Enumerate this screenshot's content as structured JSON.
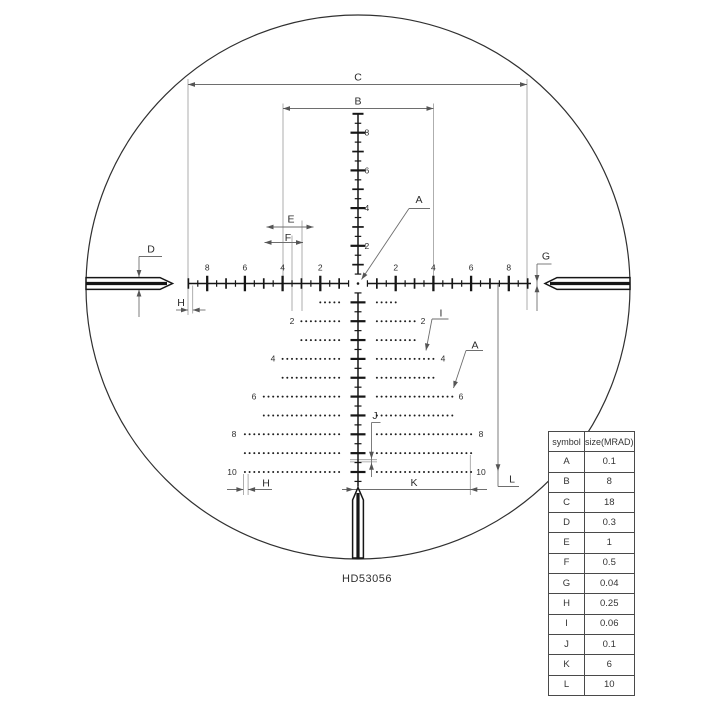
{
  "hd_label": "HD53056",
  "table": {
    "headers": [
      "symbol",
      "size(MRAD)"
    ],
    "rows": [
      [
        "A",
        "0.1"
      ],
      [
        "B",
        "8"
      ],
      [
        "C",
        "18"
      ],
      [
        "D",
        "0.3"
      ],
      [
        "E",
        "1"
      ],
      [
        "F",
        "0.5"
      ],
      [
        "G",
        "0.04"
      ],
      [
        "H",
        "0.25"
      ],
      [
        "I",
        "0.06"
      ],
      [
        "J",
        "0.1"
      ],
      [
        "K",
        "6"
      ],
      [
        "L",
        "10"
      ]
    ]
  },
  "chart_data": {
    "type": "diagram-reticle",
    "title": "HD53056 reticle subtension diagram",
    "units": "MRAD",
    "subtensions": {
      "A": 0.1,
      "B": 8,
      "C": 18,
      "D": 0.3,
      "E": 1,
      "F": 0.5,
      "G": 0.04,
      "H": 0.25,
      "I": 0.06,
      "J": 0.1,
      "K": 6,
      "L": 10
    }
  },
  "reticle": {
    "geom": {
      "cx": 358,
      "cy": 283.5,
      "scale": 18.85,
      "circle": [
        358,
        287,
        272
      ],
      "h_segments": [
        [
          188,
          348.5
        ],
        [
          367.5,
          531
        ]
      ],
      "v_segments_y": [
        [
          113.8,
          273.5
        ],
        [
          292.5,
          486.5
        ]
      ],
      "h_tick_range": [
        -9,
        9
      ],
      "v_up_max": 8.5,
      "v_down_max": 10.5
    },
    "h_axis_labels": [
      {
        "text": "8",
        "mrad": -8
      },
      {
        "text": "6",
        "mrad": -6
      },
      {
        "text": "4",
        "mrad": -4
      },
      {
        "text": "2",
        "mrad": -2
      },
      {
        "text": "2",
        "mrad": 2
      },
      {
        "text": "4",
        "mrad": 4
      },
      {
        "text": "6",
        "mrad": 6
      },
      {
        "text": "8",
        "mrad": 8
      }
    ],
    "v_axis_labels": [
      {
        "text": "8",
        "mrad": 8
      },
      {
        "text": "6",
        "mrad": 6
      },
      {
        "text": "4",
        "mrad": 4
      },
      {
        "text": "2",
        "mrad": 2
      }
    ],
    "tree_rows": [
      {
        "mrad": 1,
        "outer": 2
      },
      {
        "mrad": 2,
        "outer": 3
      },
      {
        "mrad": 3,
        "outer": 3
      },
      {
        "mrad": 4,
        "outer": 4
      },
      {
        "mrad": 5,
        "outer": 4
      },
      {
        "mrad": 6,
        "outer": 5
      },
      {
        "mrad": 7,
        "outer": 5
      },
      {
        "mrad": 8,
        "outer": 6
      },
      {
        "mrad": 9,
        "outer": 6
      },
      {
        "mrad": 10,
        "outer": 6
      }
    ],
    "dot_step": 0.25,
    "tree_row_labels": [
      {
        "text": "2",
        "mrad": 2,
        "lx": 292,
        "rx": 423
      },
      {
        "text": "4",
        "mrad": 4,
        "lx": 273,
        "rx": 443
      },
      {
        "text": "6",
        "mrad": 6,
        "lx": 254,
        "rx": 461
      },
      {
        "text": "8",
        "mrad": 8,
        "lx": 234,
        "rx": 481
      },
      {
        "text": "10",
        "mrad": 10,
        "lx": 232,
        "rx": 481
      }
    ],
    "ext_lines": [
      [
        188,
        79,
        188,
        315
      ],
      [
        527,
        79,
        527,
        310
      ],
      [
        283,
        103.5,
        283,
        282.5
      ],
      [
        433.5,
        103.5,
        433.5,
        282.5
      ],
      [
        292,
        235.5,
        292,
        311
      ],
      [
        302,
        220.5,
        302,
        311
      ],
      [
        192.7,
        285.5,
        192.7,
        313.5
      ],
      [
        243.4,
        474,
        243.4,
        495
      ],
      [
        248.1,
        474,
        248.1,
        495
      ],
      [
        470.3,
        455,
        470.3,
        495
      ],
      [
        350,
        459.7,
        377,
        459.7
      ],
      [
        350,
        461.9,
        377,
        461.9
      ]
    ],
    "dimensions": [
      {
        "letter": "C",
        "label": [
          358,
          80.5
        ],
        "lines": [
          [
            188,
            84.5,
            527,
            84.5
          ]
        ],
        "heads": [
          [
            188,
            84.5,
            180
          ],
          [
            527,
            84.5,
            0
          ]
        ]
      },
      {
        "letter": "B",
        "label": [
          358,
          104.5
        ],
        "lines": [
          [
            283,
            108.5,
            433.5,
            108.5
          ]
        ],
        "heads": [
          [
            283,
            108.5,
            180
          ],
          [
            433.5,
            108.5,
            0
          ]
        ]
      },
      {
        "letter": "A",
        "label": [
          419,
          203
        ],
        "lines": [
          [
            430,
            208.5,
            409,
            208.5
          ],
          [
            409,
            208.5,
            361.5,
            279.5
          ]
        ],
        "heads": [
          [
            361.5,
            279.5,
            124
          ]
        ]
      },
      {
        "letter": "E",
        "label": [
          291,
          222.5
        ],
        "lines": [
          [
            266.5,
            227,
            313.5,
            227
          ]
        ],
        "heads": [
          [
            266.5,
            227,
            180
          ],
          [
            313.5,
            227,
            0
          ]
        ]
      },
      {
        "letter": "F",
        "label": [
          288,
          241
        ],
        "lines": [
          [
            264.5,
            242.5,
            303,
            242.5
          ]
        ],
        "heads": [
          [
            264.5,
            242.5,
            180
          ],
          [
            303,
            242.5,
            0
          ]
        ]
      },
      {
        "letter": "D",
        "label": [
          151,
          252.5
        ],
        "lines": [
          [
            139,
            256.5,
            162,
            256.5
          ],
          [
            139,
            256.5,
            139,
            317
          ]
        ],
        "heads": [
          [
            139,
            277,
            90
          ],
          [
            139,
            289.5,
            270
          ]
        ]
      },
      {
        "letter": "G",
        "label": [
          546,
          259.5
        ],
        "lines": [
          [
            537,
            264,
            551.5,
            264
          ],
          [
            537,
            264,
            537,
            311
          ]
        ],
        "heads": [
          [
            537,
            282,
            90
          ],
          [
            537,
            285.3,
            270
          ]
        ]
      },
      {
        "letter": "H",
        "label": [
          181,
          306
        ],
        "lines": [
          [
            176,
            310,
            188,
            310
          ],
          [
            205.5,
            310,
            192.7,
            310
          ]
        ],
        "heads": [
          [
            188,
            310,
            0
          ],
          [
            192.7,
            310,
            180
          ]
        ]
      },
      {
        "letter": "H",
        "label": [
          266,
          486.5
        ],
        "lines": [
          [
            227,
            489.5,
            243.4,
            489.5
          ],
          [
            272,
            489.5,
            248.1,
            489.5
          ]
        ],
        "heads": [
          [
            243.4,
            489.5,
            0
          ],
          [
            248.1,
            489.5,
            180
          ]
        ]
      },
      {
        "letter": "I",
        "label": [
          441,
          316.5
        ],
        "lines": [
          [
            448.5,
            319,
            432,
            319
          ],
          [
            432,
            319,
            426,
            350.5
          ]
        ],
        "heads": [
          [
            426,
            350.5,
            101
          ]
        ]
      },
      {
        "letter": "A",
        "label": [
          475,
          348.5
        ],
        "lines": [
          [
            483,
            350.5,
            466,
            350.5
          ],
          [
            466,
            350.5,
            453.5,
            388
          ]
        ],
        "heads": [
          [
            453.5,
            388,
            108
          ]
        ]
      },
      {
        "letter": "J",
        "label": [
          375,
          419
        ],
        "lines": [
          [
            371.5,
            422.5,
            380.5,
            422.5
          ],
          [
            371.5,
            422.5,
            371.5,
            477
          ]
        ],
        "heads": [
          [
            371.5,
            458.8,
            90
          ],
          [
            371.5,
            462.8,
            270
          ]
        ]
      },
      {
        "letter": "K",
        "label": [
          414,
          486
        ],
        "lines": [
          [
            342,
            489.5,
            487,
            489.5
          ]
        ],
        "heads": [
          [
            353.5,
            489.5,
            0
          ],
          [
            470.3,
            489.5,
            180
          ]
        ]
      },
      {
        "letter": "L",
        "label": [
          512,
          482.5
        ],
        "lines": [
          [
            498,
            284.5,
            498,
            486.5
          ],
          [
            498,
            486.5,
            519,
            486.5
          ]
        ],
        "heads": [
          [
            498,
            471.3,
            90
          ]
        ]
      }
    ]
  }
}
